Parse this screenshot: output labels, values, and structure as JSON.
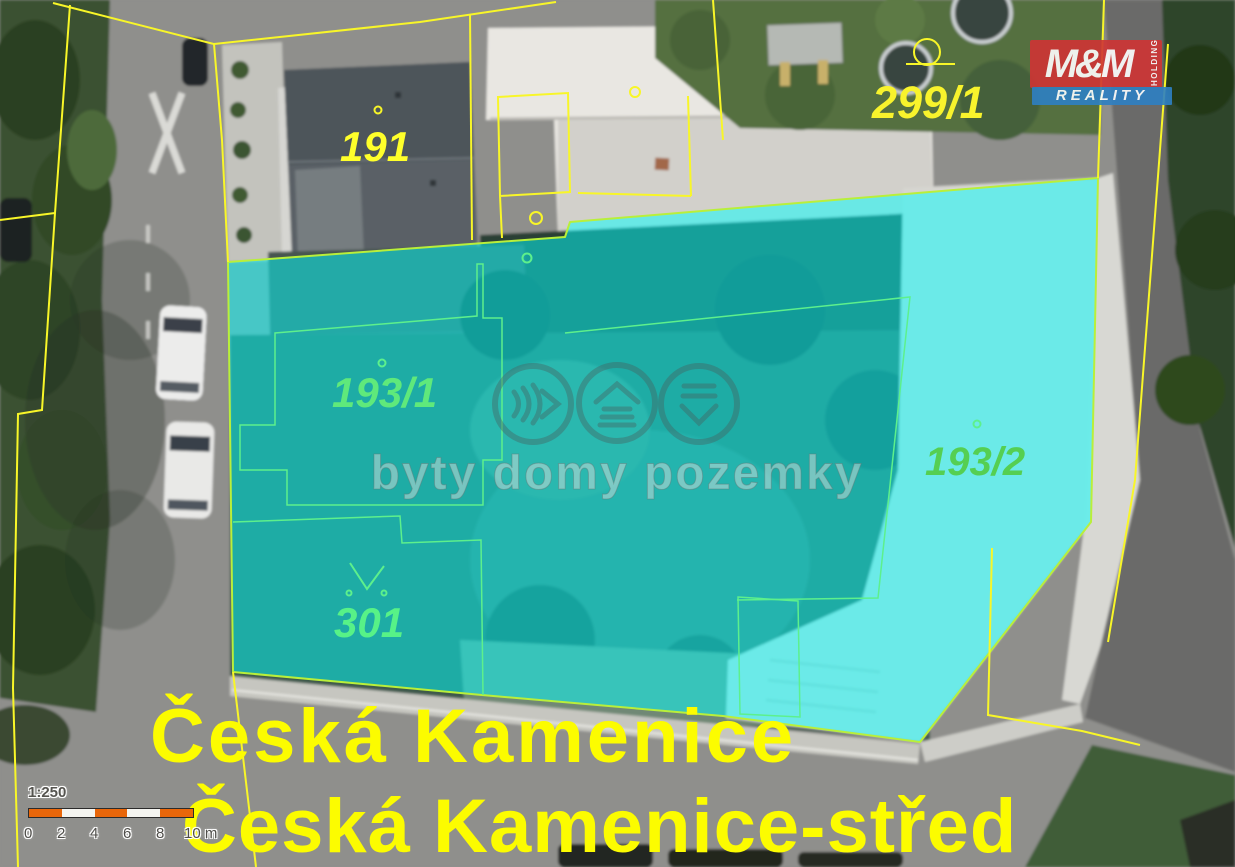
{
  "map": {
    "type": "cadastral-aerial-map",
    "parcels": [
      {
        "label": "191",
        "label_color": "#ffff2a",
        "highlighted": false
      },
      {
        "label": "299/1",
        "label_color": "#f8f32c",
        "highlighted": false
      },
      {
        "label": "193/1",
        "label_color": "#5fe97b",
        "highlighted": true
      },
      {
        "label": "193/2",
        "label_color": "#55cf52",
        "highlighted": true
      },
      {
        "label": "301",
        "label_color": "#57f287",
        "highlighted": true
      }
    ],
    "place_labels": {
      "line1": "Česká Kamenice",
      "line2": "Česká Kamenice-střed"
    }
  },
  "scale_bar": {
    "ratio": "1:250",
    "ticks": [
      "0",
      "2",
      "4",
      "6",
      "8",
      "10 m"
    ]
  },
  "watermark": {
    "text": "byty domy pozemky",
    "icons": [
      "soundwave-chevron-icon",
      "house-chevron-icon",
      "stack-chevron-down-icon"
    ]
  },
  "logo": {
    "mm": "M&M",
    "reality": "REALITY",
    "holding": "HOLDING"
  },
  "colors": {
    "highlight_overlay": "#00ffff",
    "highlight_border": "#b9ef3a",
    "inner_parcel_line": "#5df08c",
    "cadastral_line": "#f8f628",
    "place_label": "#fcfc00",
    "logo_red": "#cf3434",
    "logo_blue": "#2e80c3",
    "scale_orange": "#e8660a"
  }
}
